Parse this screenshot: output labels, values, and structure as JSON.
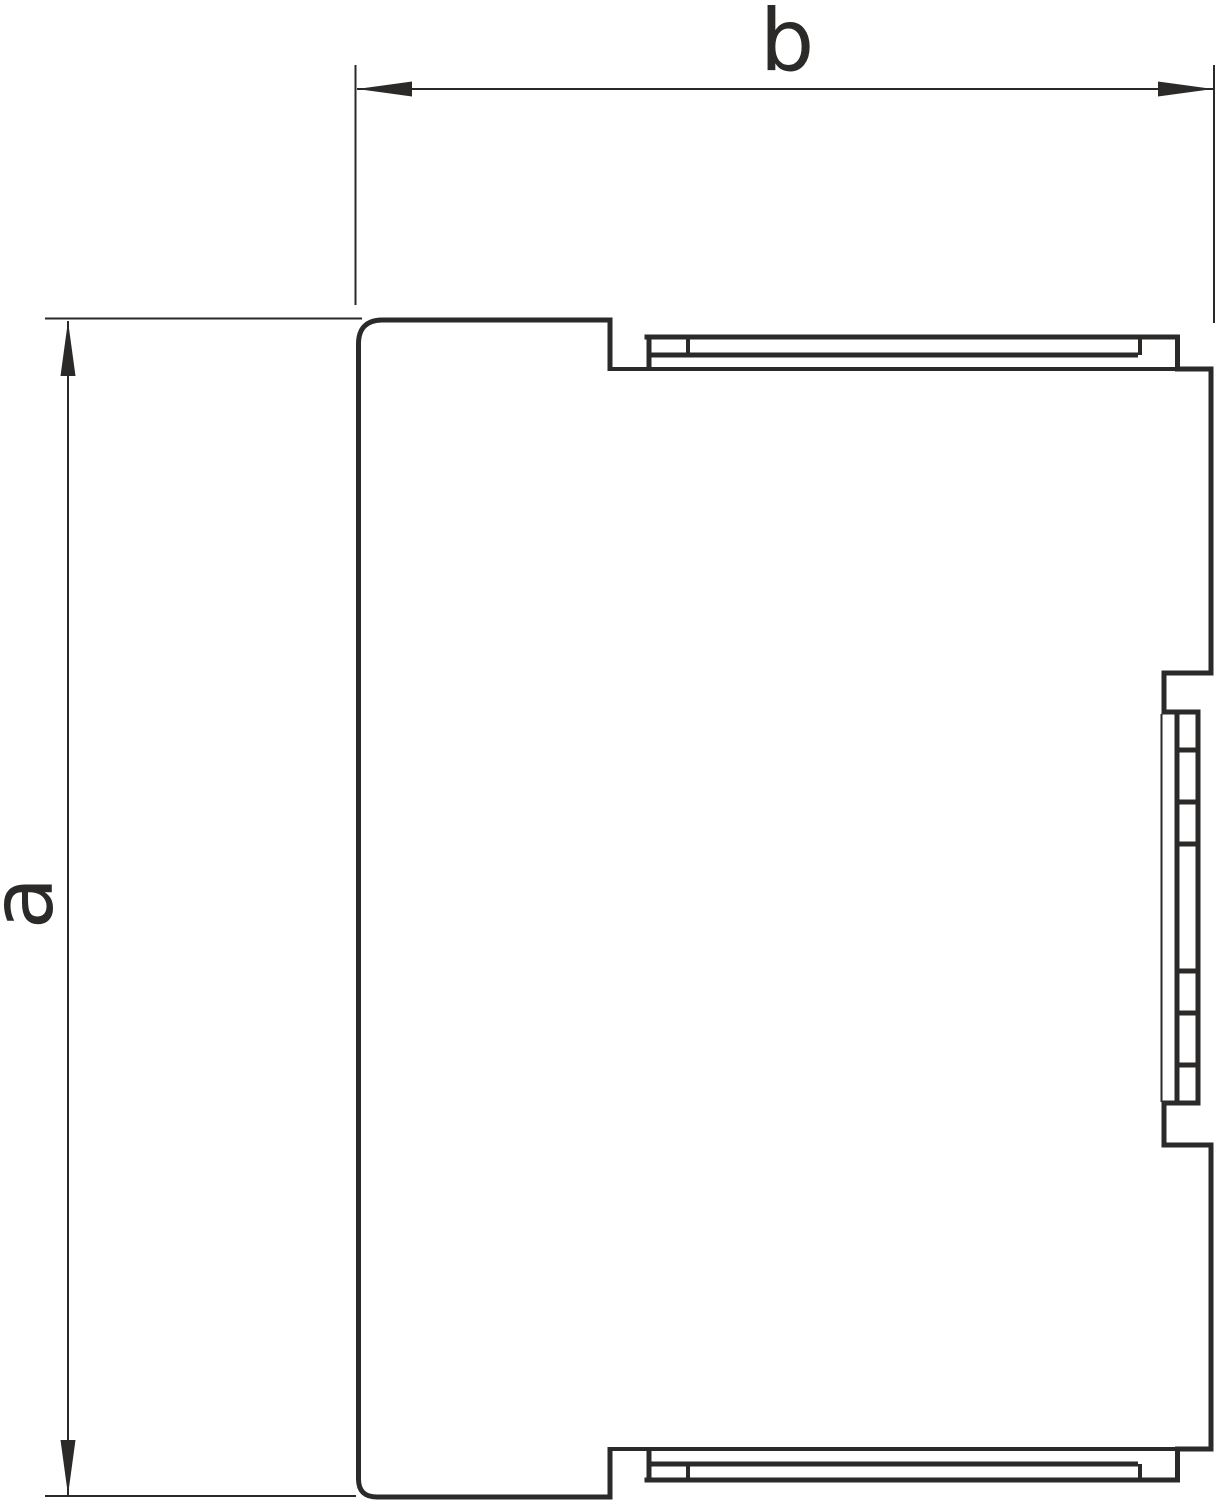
{
  "drawing": {
    "kind": "technical dimension drawing, side view of trunking end piece",
    "labels": {
      "width_dimension": "b",
      "height_dimension": "a"
    },
    "colors": {
      "line": "#2b2a29",
      "background": "#ffffff"
    }
  }
}
